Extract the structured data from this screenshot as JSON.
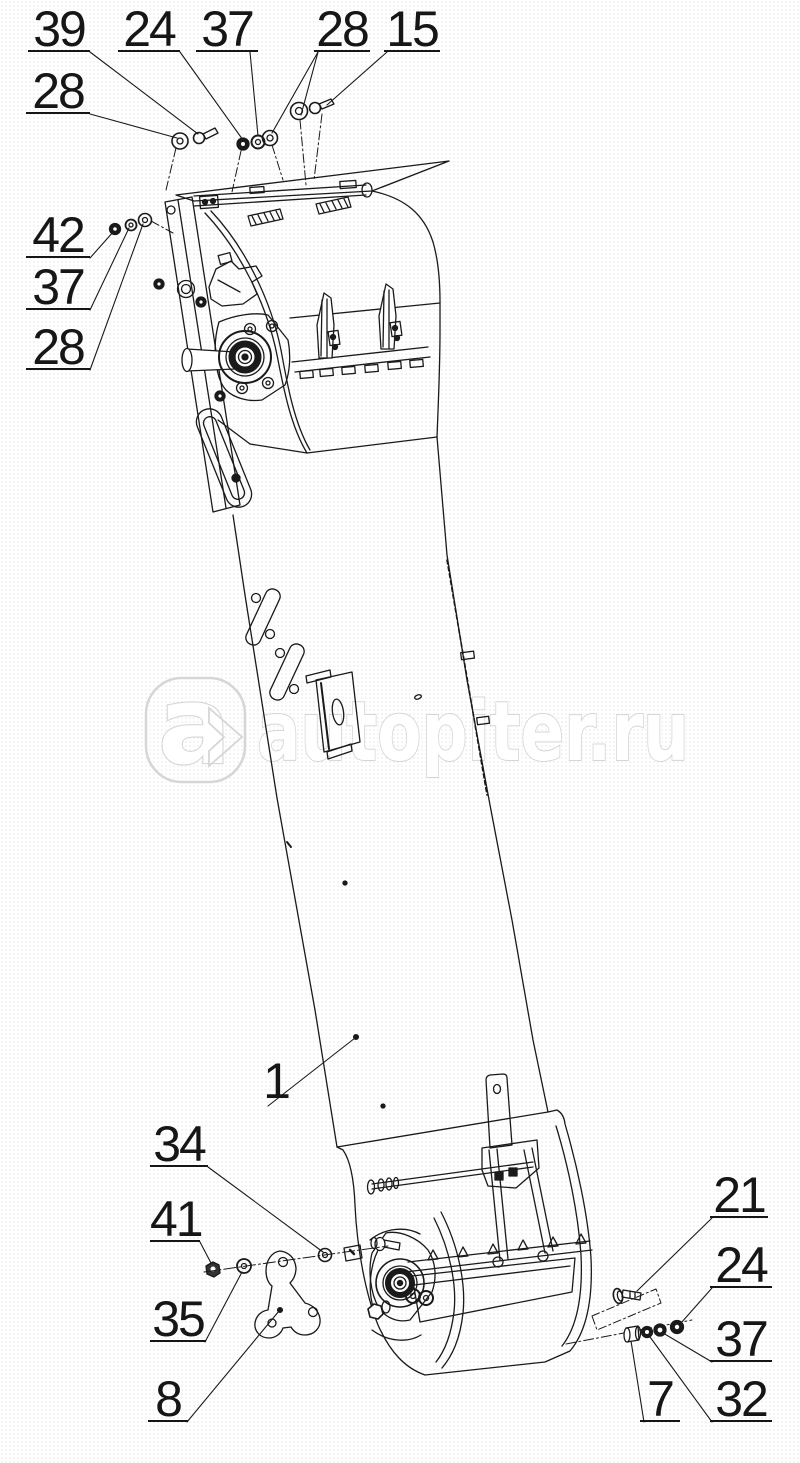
{
  "diagram": {
    "type": "exploded-parts-drawing",
    "line_color": "#1a1a1a",
    "callouts": [
      {
        "label": "39"
      },
      {
        "label": "24"
      },
      {
        "label": "37"
      },
      {
        "label": "28"
      },
      {
        "label": "15"
      },
      {
        "label": "28"
      },
      {
        "label": "42"
      },
      {
        "label": "37"
      },
      {
        "label": "28"
      },
      {
        "label": "1"
      },
      {
        "label": "34"
      },
      {
        "label": "41"
      },
      {
        "label": "35"
      },
      {
        "label": "8"
      },
      {
        "label": "21"
      },
      {
        "label": "24"
      },
      {
        "label": "37"
      },
      {
        "label": "32"
      },
      {
        "label": "7"
      }
    ]
  },
  "watermark": {
    "logo_letter": "a",
    "site": "autopiter.ru",
    "color": "#d6d6d6"
  }
}
